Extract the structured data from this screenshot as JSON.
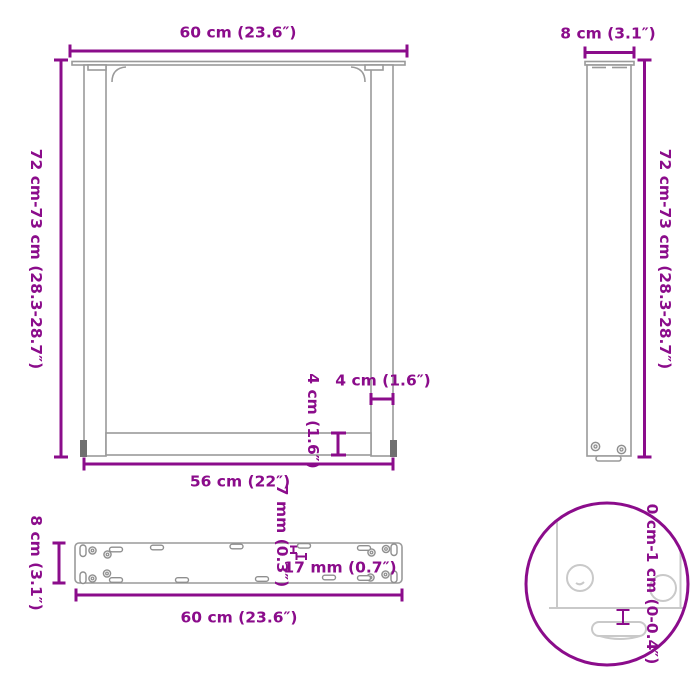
{
  "title": "table-leg-dimension-diagram",
  "colors": {
    "dimension": "#8B0C8B",
    "drawing_line": "#9a9a9a",
    "detail_line": "#c9c9c9"
  },
  "front_view": {
    "width_top": "60 cm (23.6″)",
    "height_left": "72 cm-73 cm (28.3-28.7″)",
    "width_bottom": "56 cm (22″)",
    "leg_width": "4 cm (1.6″)",
    "crossbar_height": "4 cm (1.6″)"
  },
  "side_view": {
    "depth_top": "8 cm (3.1″)",
    "height_right": "72 cm-73 cm (28.3-28.7″)"
  },
  "plate_view": {
    "depth_left": "8 cm (3.1″)",
    "width_bottom": "60 cm (23.6″)",
    "slot_offset": "7 mm (0.3″)",
    "slot_length": "17 mm (0.7″)"
  },
  "detail_view": {
    "adjustable_height": "0 cm-1 cm (0-0.4″)"
  }
}
